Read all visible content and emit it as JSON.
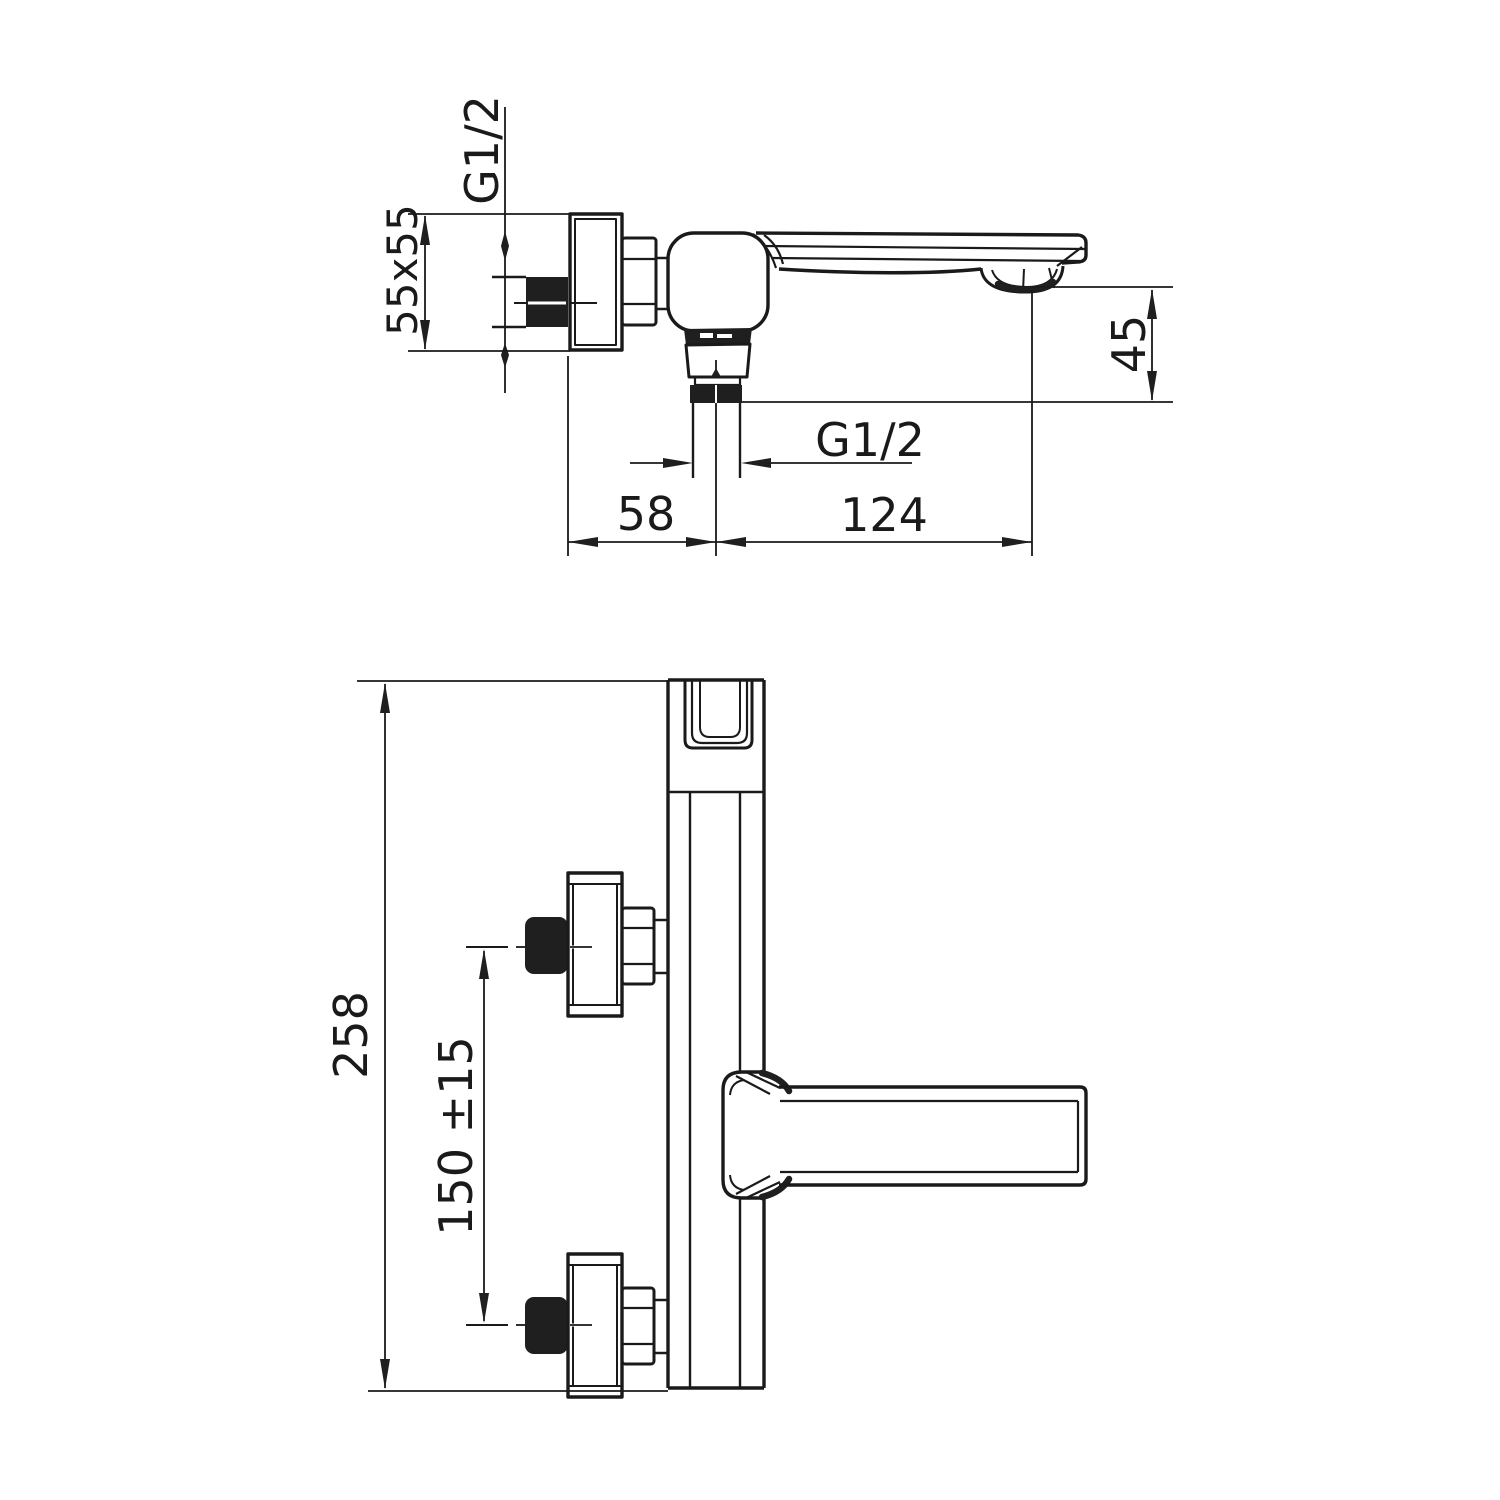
{
  "colors": {
    "ink": "#1a1a1a",
    "background": "#ffffff"
  },
  "top_view": {
    "labels": {
      "wall_thread": "G1/2",
      "flange_square": "55x55",
      "spout_drop": "45",
      "outlet_thread": "G1/2",
      "wall_to_outlet_axis": "58",
      "outlet_axis_to_tip": "124"
    }
  },
  "front_view": {
    "labels": {
      "overall_height": "258",
      "connection_spacing": "150 ±15"
    }
  }
}
